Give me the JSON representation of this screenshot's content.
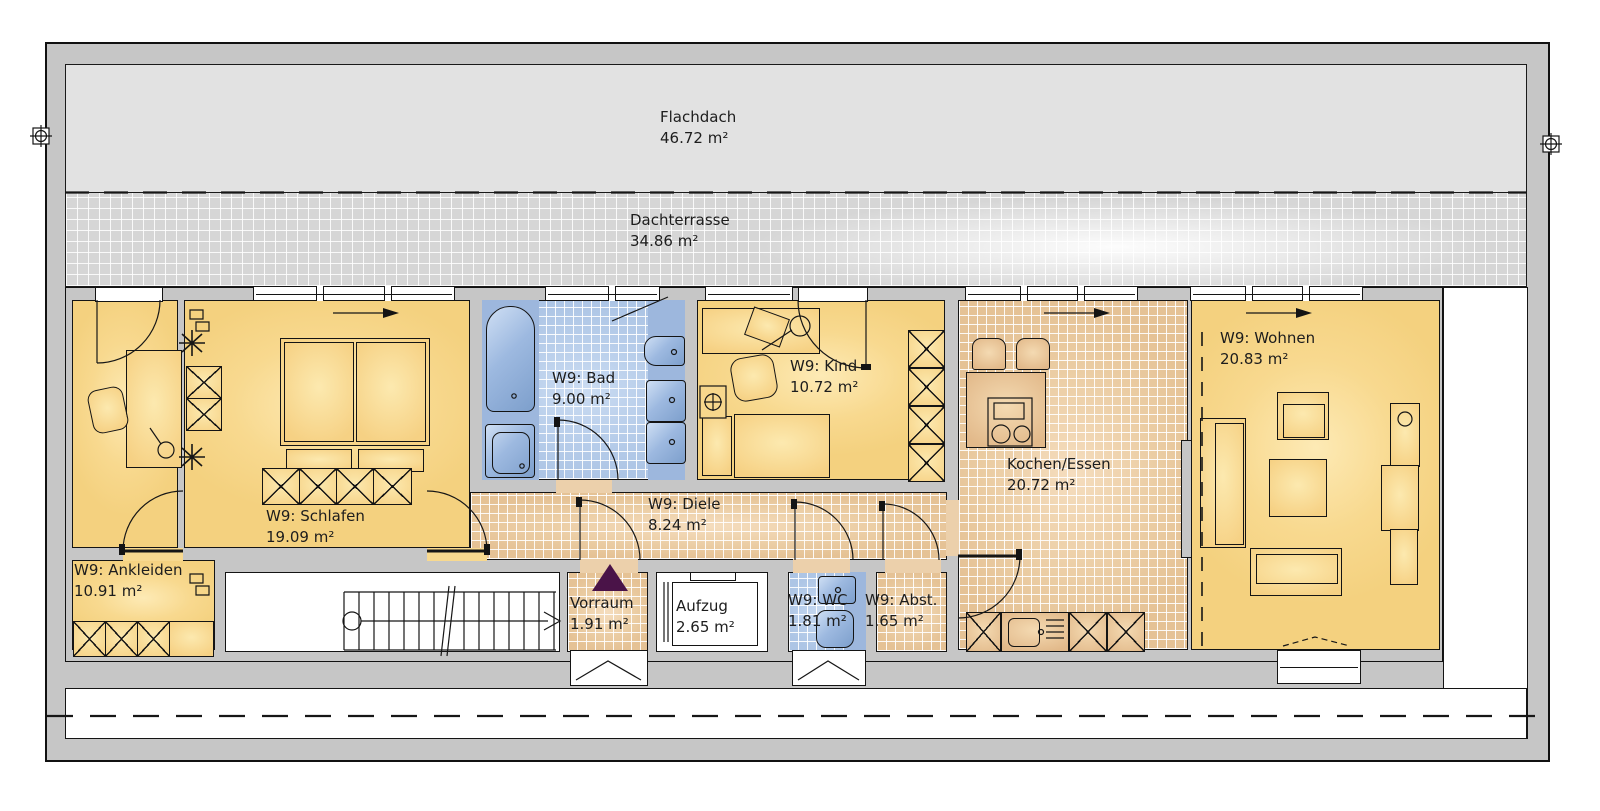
{
  "rooms": [
    {
      "id": "flachdach",
      "name": "Flachdach",
      "area": "46.72 m²"
    },
    {
      "id": "dachterrasse",
      "name": "Dachterrasse",
      "area": "34.86 m²"
    },
    {
      "id": "ankleiden",
      "name": "W9: Ankleiden",
      "area": "10.91 m²"
    },
    {
      "id": "schlafen",
      "name": "W9: Schlafen",
      "area": "19.09 m²"
    },
    {
      "id": "bad",
      "name": "W9: Bad",
      "area": "9.00 m²"
    },
    {
      "id": "kind",
      "name": "W9: Kind",
      "area": "10.72 m²"
    },
    {
      "id": "diele",
      "name": "W9: Diele",
      "area": "8.24 m²"
    },
    {
      "id": "kochen_essen",
      "name": "Kochen/Essen",
      "area": "20.72 m²"
    },
    {
      "id": "wohnen",
      "name": "W9: Wohnen",
      "area": "20.83 m²"
    },
    {
      "id": "vorraum",
      "name": "Vorraum",
      "area": "1.91 m²"
    },
    {
      "id": "aufzug",
      "name": "Aufzug",
      "area": "2.65 m²"
    },
    {
      "id": "wc",
      "name": "W9: WC",
      "area": "1.81 m²"
    },
    {
      "id": "abst",
      "name": "W9: Abst.",
      "area": "1.65 m²"
    }
  ],
  "colors": {
    "room_yellow": "#f8d98f",
    "tile_terracotta": "#ecd0ab",
    "tile_blue": "#b7cdea",
    "fixture_blue": "#9db7dd",
    "roof_gray": "#e2e2e2",
    "terrace_gray": "#d6d6d6",
    "wall_gray": "#c6c6c6",
    "entry_triangle_purple": "#4a1348"
  }
}
